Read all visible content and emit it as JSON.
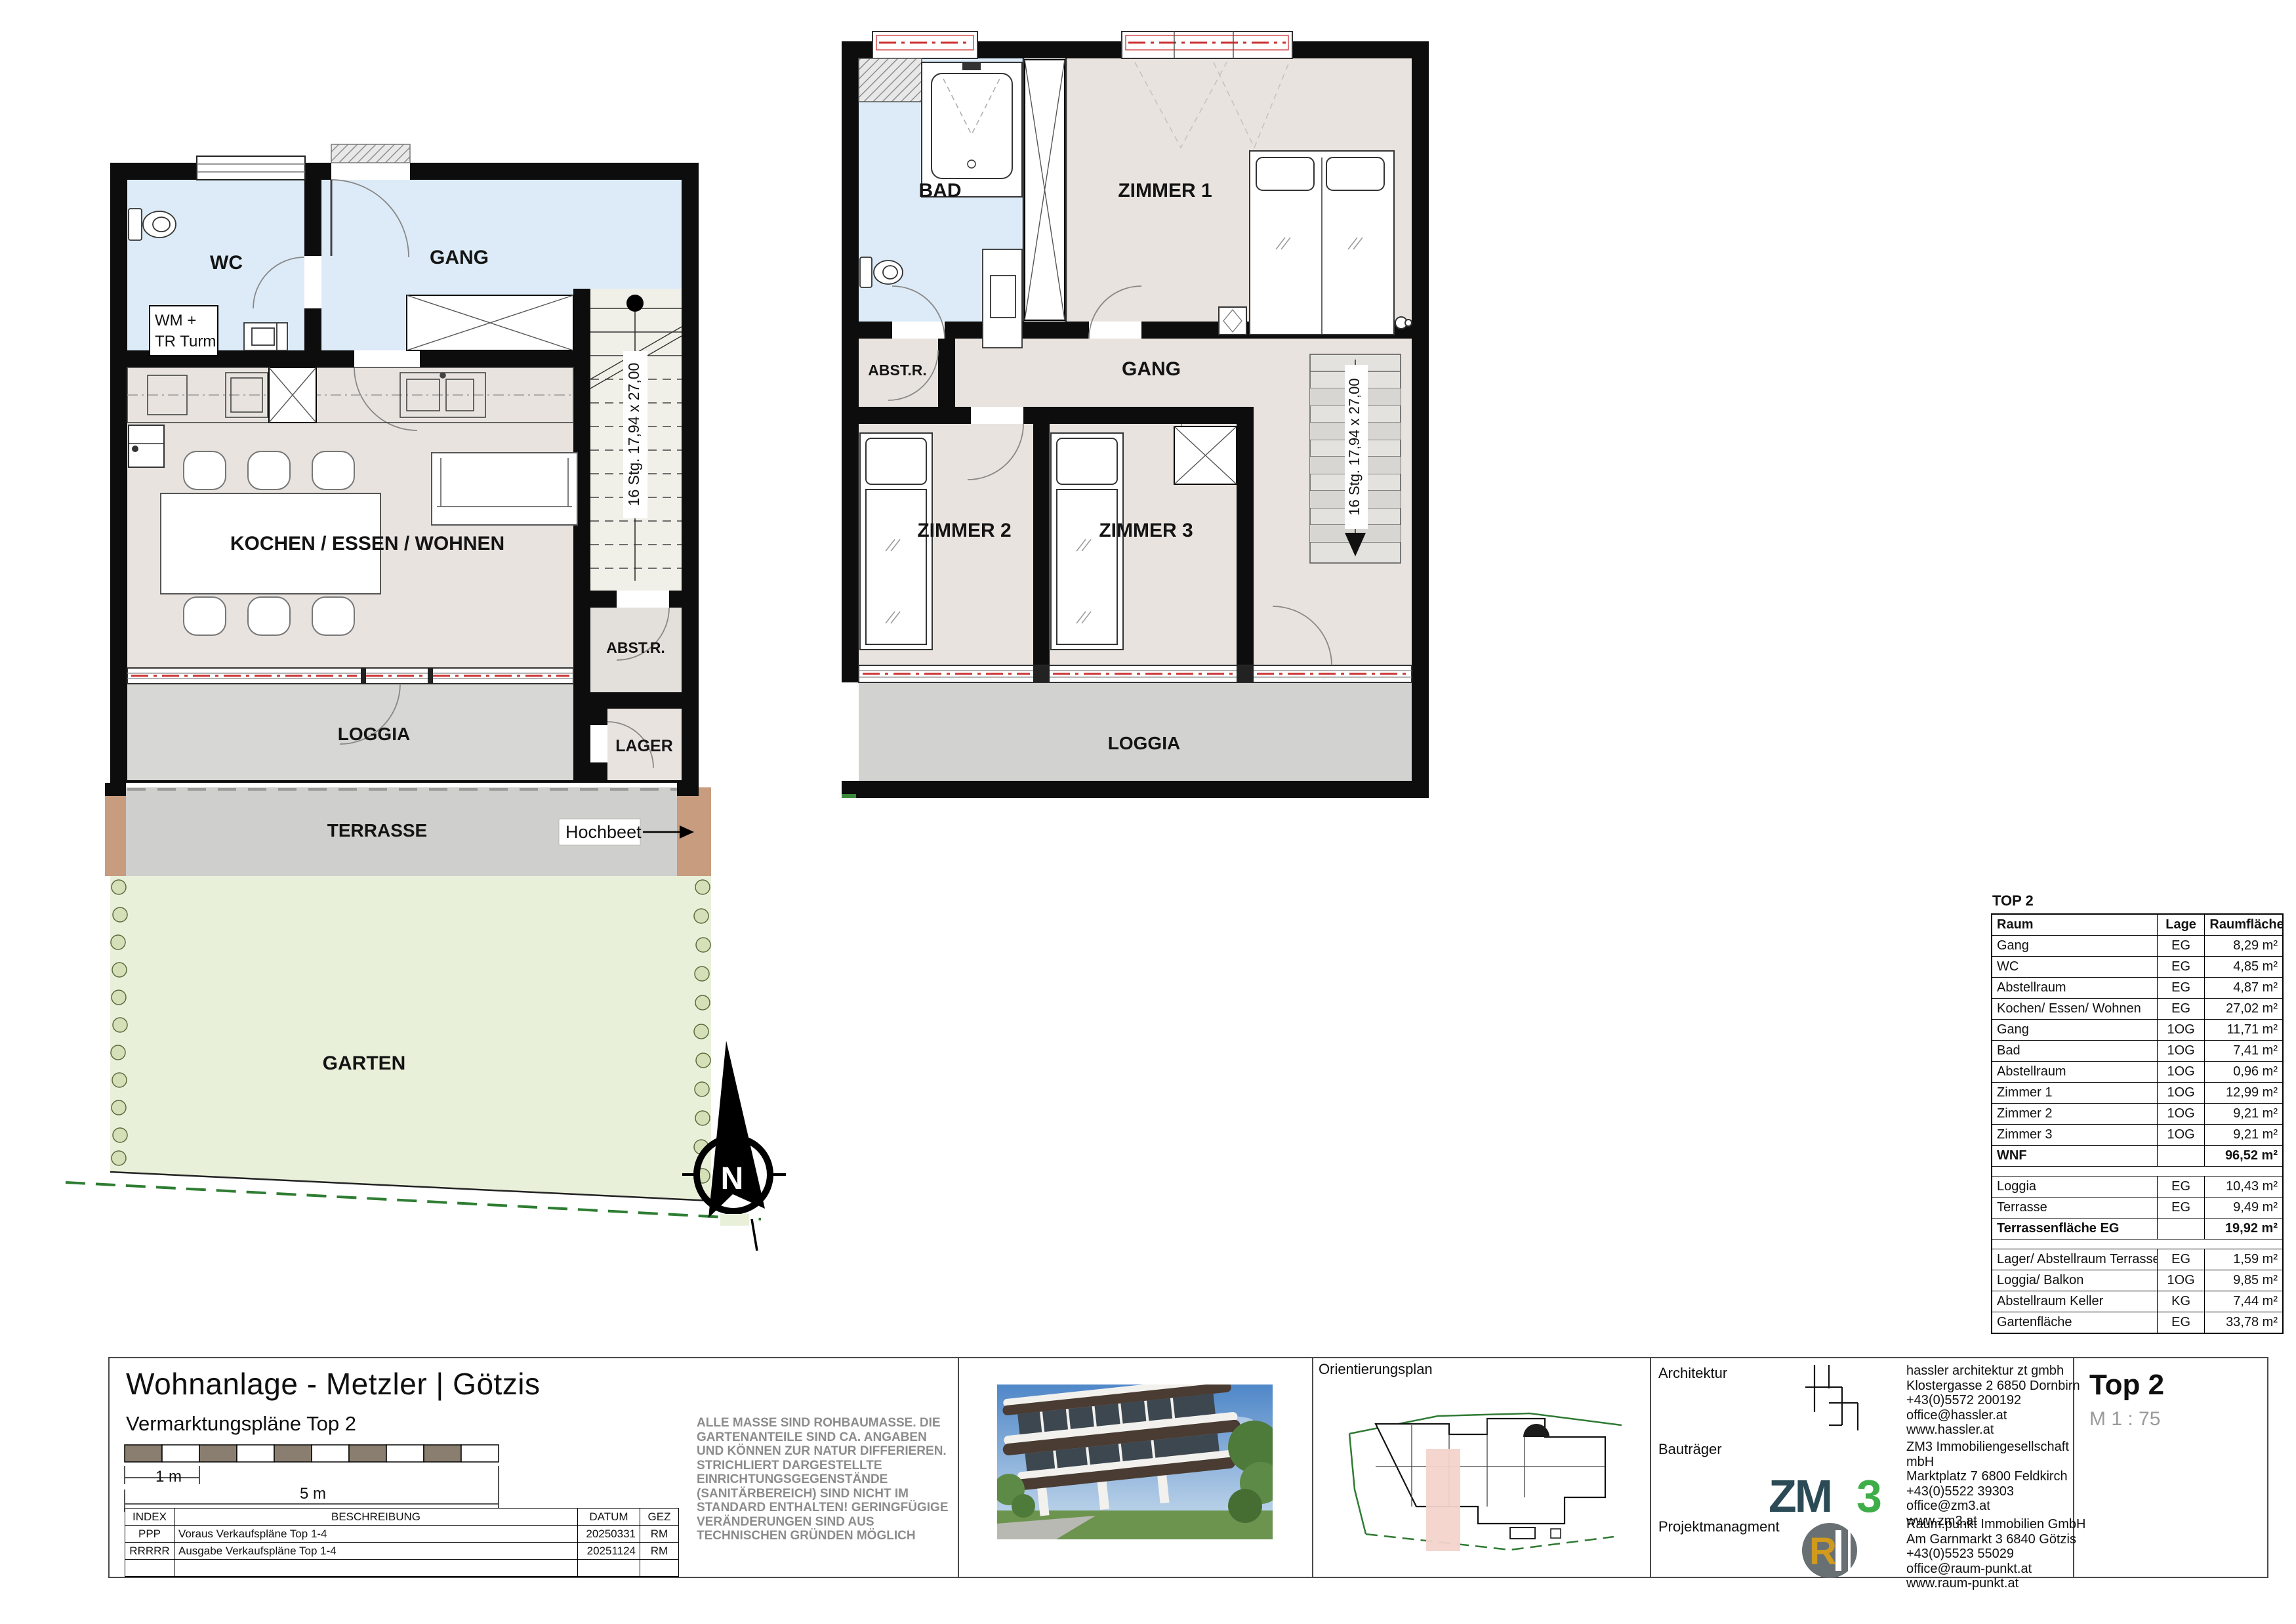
{
  "sheet": {
    "title": "Wohnanlage - Metzler | Götzis",
    "subtitle": "Vermarktungspläne Top 2",
    "scale_bar": {
      "m1": "1 m",
      "m5": "5 m"
    },
    "index_table": {
      "headers": {
        "index": "INDEX",
        "beschreibung": "BESCHREIBUNG",
        "datum": "DATUM",
        "gez": "GEZ"
      },
      "rows": [
        {
          "index": "PPP",
          "beschreibung": "Voraus Verkaufspläne Top 1-4",
          "datum": "20250331",
          "gez": "RM"
        },
        {
          "index": "RRRRR",
          "beschreibung": "Ausgabe Verkaufspläne Top 1-4",
          "datum": "20251124",
          "gez": "RM"
        },
        {
          "index": "",
          "beschreibung": "",
          "datum": "",
          "gez": ""
        }
      ]
    },
    "disclaimer": "ALLE MASSE SIND ROHBAUMASSE. DIE GARTENANTEILE SIND CA. ANGABEN UND KÖNNEN ZUR NATUR DIFFERIEREN. STRICHLIERT DARGESTELLTE EINRICHTUNGSGEGENSTÄNDE (SANITÄRBEREICH) SIND NICHT IM STANDARD ENTHALTEN! GERINGFÜGIGE VERÄNDERUNGEN SIND AUS TECHNISCHEN GRÜNDEN MÖGLICH",
    "orientierungsplan_label": "Orientierungsplan",
    "stamp": {
      "unit": "Top 2",
      "scale": "M 1 : 75"
    },
    "contacts": [
      {
        "role": "Architektur",
        "lines": [
          "hassler architektur zt gmbh",
          "Klostergasse 2    6850 Dornbirn",
          "+43(0)5572 200192",
          "office@hassler.at",
          "www.hassler.at"
        ]
      },
      {
        "role": "Bauträger",
        "lines": [
          "ZM3 Immobiliengesellschaft",
          "mbH",
          "Marktplatz 7    6800 Feldkirch",
          "+43(0)5522 39303",
          "office@zm3.at",
          "www.zm3.at"
        ]
      },
      {
        "role": "Projektmanagment",
        "lines": [
          "Raum.punkt Immobilien GmbH",
          "Am Garnmarkt 3    6840 Götzis",
          "+43(0)5523 55029",
          "office@raum-punkt.at",
          "www.raum-punkt.at"
        ]
      }
    ],
    "logos": {
      "zm3_zm": "ZM",
      "zm3_3": "3",
      "rp_r": "R"
    }
  },
  "area_table": {
    "title": "TOP 2",
    "headers": {
      "raum": "Raum",
      "lage": "Lage",
      "flaeche": "Raumfläche"
    },
    "rows": [
      {
        "raum": "Gang",
        "lage": "EG",
        "flaeche": "8,29 m²"
      },
      {
        "raum": "WC",
        "lage": "EG",
        "flaeche": "4,85 m²"
      },
      {
        "raum": "Abstellraum",
        "lage": "EG",
        "flaeche": "4,87 m²"
      },
      {
        "raum": "Kochen/ Essen/ Wohnen",
        "lage": "EG",
        "flaeche": "27,02 m²"
      },
      {
        "raum": "Gang",
        "lage": "1OG",
        "flaeche": "11,71 m²"
      },
      {
        "raum": "Bad",
        "lage": "1OG",
        "flaeche": "7,41 m²"
      },
      {
        "raum": "Abstellraum",
        "lage": "1OG",
        "flaeche": "0,96 m²"
      },
      {
        "raum": "Zimmer 1",
        "lage": "1OG",
        "flaeche": "12,99 m²"
      },
      {
        "raum": "Zimmer 2",
        "lage": "1OG",
        "flaeche": "9,21 m²"
      },
      {
        "raum": "Zimmer 3",
        "lage": "1OG",
        "flaeche": "9,21 m²"
      },
      {
        "raum": "WNF",
        "lage": "",
        "flaeche": "96,52 m²"
      },
      {
        "raum": "Loggia",
        "lage": "EG",
        "flaeche": "10,43 m²"
      },
      {
        "raum": "Terrasse",
        "lage": "EG",
        "flaeche": "9,49 m²"
      },
      {
        "raum": "Terrassenfläche EG",
        "lage": "",
        "flaeche": "19,92 m²"
      },
      {
        "raum": "Lager/ Abstellraum Terrasse",
        "lage": "EG",
        "flaeche": "1,59 m²"
      },
      {
        "raum": "Loggia/ Balkon",
        "lage": "1OG",
        "flaeche": "9,85 m²"
      },
      {
        "raum": "Abstellraum Keller",
        "lage": "KG",
        "flaeche": "7,44 m²"
      },
      {
        "raum": "Gartenfläche",
        "lage": "EG",
        "flaeche": "33,78 m²"
      }
    ]
  },
  "plans": {
    "eg": {
      "labels": {
        "wc": "WC",
        "gang": "GANG",
        "wm1": "WM +",
        "wm2": "TR Turm",
        "kochen": "KOCHEN / ESSEN / WOHNEN",
        "abstr": "ABST.R.",
        "loggia": "LOGGIA",
        "lager": "LAGER",
        "terrasse": "TERRASSE",
        "hochbeet": "Hochbeet",
        "garten": "GARTEN"
      },
      "stair_label": "16 Stg. 17,94 x 27,00"
    },
    "og": {
      "labels": {
        "bad": "BAD",
        "zimmer1": "ZIMMER 1",
        "abstr": "ABST.R.",
        "gang": "GANG",
        "zimmer2": "ZIMMER 2",
        "zimmer3": "ZIMMER 3",
        "loggia": "LOGGIA"
      },
      "stair_label": "16 Stg. 17,94 x 27,00"
    },
    "compass_n": "N"
  },
  "colors": {
    "wall": "#0d0d0d",
    "floor_blue": "#dcebf7",
    "floor_beige": "#e8e3df",
    "loggia_gray": "#d7d7d5",
    "terrasse_gray": "#cfcfcd",
    "garden_green": "#e9f0da",
    "hochbeet_brown": "#c79c7f",
    "shutter_red": "#cc3333",
    "zm3_dark": "#2b4a55",
    "zm3_green": "#3fae49",
    "rp_gold": "#d09a1e"
  }
}
